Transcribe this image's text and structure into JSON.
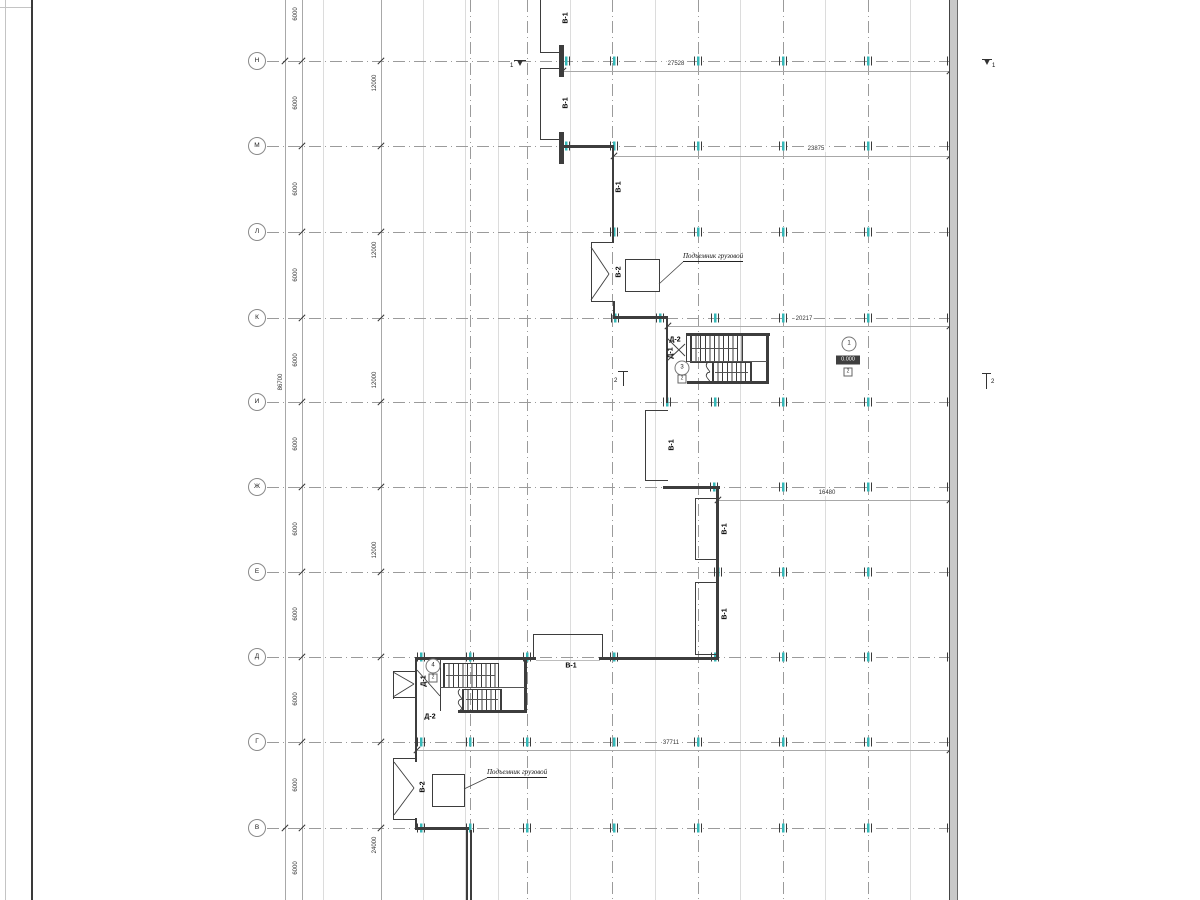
{
  "drawing_title": "floor-plan",
  "colors": {
    "wall": "#3d3d3d",
    "grid": "#9b9b9b",
    "tick_teal": "#35b8b8",
    "dim": "#a8a8a8",
    "elev_bg": "#3f3f3f"
  },
  "frame": {
    "lines_x": [
      5,
      31
    ],
    "top_line_y": 7
  },
  "grid": {
    "circle_x": 257,
    "line_x1": 267,
    "line_x2": 957,
    "rows": [
      {
        "label": "Н",
        "y": 61
      },
      {
        "label": "М",
        "y": 146
      },
      {
        "label": "Л",
        "y": 232
      },
      {
        "label": "К",
        "y": 318
      },
      {
        "label": "И",
        "y": 402
      },
      {
        "label": "Ж",
        "y": 487
      },
      {
        "label": "Е",
        "y": 572
      },
      {
        "label": "Д",
        "y": 657
      },
      {
        "label": "Г",
        "y": 742
      },
      {
        "label": "В",
        "y": 828
      }
    ],
    "columns_x": [
      470,
      527,
      612,
      698,
      783,
      868,
      952
    ],
    "minor_x": [
      323,
      423,
      465,
      498,
      570,
      655,
      740,
      825,
      910
    ]
  },
  "ticks": [
    {
      "y": 61,
      "xs": [
        566,
        614,
        698,
        783,
        868,
        951
      ]
    },
    {
      "y": 146,
      "xs": [
        566,
        614,
        698,
        783,
        868,
        951
      ]
    },
    {
      "y": 232,
      "xs": [
        614,
        698,
        783,
        868,
        951
      ]
    },
    {
      "y": 318,
      "xs": [
        615,
        660,
        715,
        783,
        868,
        951
      ]
    },
    {
      "y": 402,
      "xs": [
        667,
        715,
        783,
        868,
        951
      ]
    },
    {
      "y": 487,
      "xs": [
        714,
        783,
        868,
        951
      ]
    },
    {
      "y": 572,
      "xs": [
        718,
        783,
        868,
        951
      ]
    },
    {
      "y": 657,
      "xs": [
        421,
        470,
        527,
        614,
        715,
        783,
        868,
        951
      ]
    },
    {
      "y": 742,
      "xs": [
        421,
        470,
        527,
        614,
        698,
        783,
        868,
        951
      ]
    },
    {
      "y": 828,
      "xs": [
        421,
        470,
        527,
        614,
        698,
        783,
        868,
        951
      ]
    }
  ],
  "chains": {
    "total": {
      "x": 285,
      "label": "86700",
      "label_y": 382,
      "slash_ys": [
        61,
        828
      ]
    },
    "seg6000": {
      "x": 302,
      "label": "6000",
      "label_ys": [
        14,
        103,
        189,
        275,
        360,
        444,
        529,
        614,
        699,
        785,
        868
      ]
    },
    "seg12000": {
      "x": 381,
      "items": [
        {
          "t": "12000",
          "y": 83
        },
        {
          "t": "12000",
          "y": 250
        },
        {
          "t": "12000",
          "y": 380
        },
        {
          "t": "12000",
          "y": 550
        },
        {
          "t": "24000",
          "y": 845
        }
      ]
    }
  },
  "hdims": [
    {
      "t": "27528",
      "y": 71,
      "x1": 563,
      "x2": 950,
      "tx": 676
    },
    {
      "t": "23875",
      "y": 156,
      "x1": 614,
      "x2": 950,
      "tx": 816
    },
    {
      "t": "20217",
      "y": 326,
      "x1": 668,
      "x2": 950,
      "tx": 804
    },
    {
      "t": "16480",
      "y": 500,
      "x1": 718,
      "x2": 950,
      "tx": 827
    },
    {
      "t": "37711",
      "y": 750,
      "x1": 417,
      "x2": 950,
      "tx": 671
    }
  ],
  "walls": {
    "thin": [
      [
        540,
        0,
        1.3,
        53
      ],
      [
        540,
        52,
        23,
        1.3
      ],
      [
        540,
        68,
        1.3,
        72
      ],
      [
        540,
        68,
        23,
        1.3
      ],
      [
        540,
        139,
        23,
        1.3
      ],
      [
        591,
        242,
        23,
        1.3
      ],
      [
        591,
        242,
        1.3,
        60
      ],
      [
        591,
        301,
        24,
        1.3
      ],
      [
        613,
        301,
        1.5,
        17
      ],
      [
        645,
        410,
        1.3,
        71
      ],
      [
        645,
        410,
        23,
        1.3
      ],
      [
        645,
        480,
        23,
        1.3
      ],
      [
        695,
        498,
        1.3,
        62
      ],
      [
        695,
        498,
        22,
        1.3
      ],
      [
        695,
        559,
        22,
        1.3
      ],
      [
        695,
        582,
        1.3,
        73
      ],
      [
        695,
        582,
        22,
        1.3
      ],
      [
        695,
        654,
        22,
        1.3
      ],
      [
        533,
        634,
        1.3,
        24
      ],
      [
        533,
        634,
        70,
        1.3
      ],
      [
        602,
        634,
        1.3,
        24
      ],
      [
        393,
        671,
        22,
        1.3
      ],
      [
        393,
        671,
        1.3,
        28
      ],
      [
        393,
        697,
        22,
        1.3
      ],
      [
        393,
        758,
        22,
        1.3
      ],
      [
        393,
        758,
        1.3,
        62
      ],
      [
        393,
        819,
        22,
        1.3
      ],
      [
        440,
        660,
        1,
        51
      ],
      [
        686,
        333,
        1.3,
        29
      ]
    ],
    "med": [
      [
        612,
        145,
        2,
        98
      ],
      [
        666,
        318,
        2,
        85
      ],
      [
        716,
        487,
        3,
        172
      ],
      [
        415,
        658,
        2,
        104
      ],
      [
        415,
        818,
        2,
        12
      ],
      [
        466,
        830,
        1.5,
        70
      ],
      [
        470,
        830,
        1.5,
        70
      ],
      [
        559,
        45,
        4.5,
        32
      ],
      [
        559,
        132,
        4.5,
        32
      ],
      [
        562,
        145,
        52,
        2.5
      ],
      [
        613,
        316,
        55,
        2.5
      ],
      [
        663,
        486,
        57,
        2.5
      ],
      [
        415,
        657,
        121,
        2.5
      ],
      [
        599,
        657,
        120,
        2.5
      ],
      [
        687,
        333,
        83,
        2.5
      ],
      [
        766,
        333,
        2.5,
        50
      ],
      [
        687,
        381,
        82,
        2.5
      ],
      [
        524,
        660,
        2.5,
        52
      ],
      [
        458,
        710,
        69,
        2.5
      ],
      [
        415,
        827,
        54,
        2.5
      ]
    ],
    "thresholds": [
      [
        536,
        659.5,
        64,
        0.8
      ]
    ]
  },
  "right_wall": {
    "x": 949,
    "y": 0,
    "w": 7,
    "h": 900
  },
  "stairs": {
    "treads": [
      {
        "x": 690,
        "y": 335,
        "w": 51,
        "h": 26,
        "step": 4.6
      },
      {
        "x": 712,
        "y": 362,
        "w": 38,
        "h": 20,
        "step": 4.6
      },
      {
        "x": 443,
        "y": 663,
        "w": 54,
        "h": 23,
        "step": 4.6
      },
      {
        "x": 462,
        "y": 689,
        "w": 38,
        "h": 20,
        "step": 4.6
      }
    ],
    "dividers": [
      [
        687,
        361,
        80,
        1
      ],
      [
        440,
        687,
        85,
        1
      ]
    ],
    "arrows": [
      [
        692,
        348,
        737,
        348
      ],
      [
        715,
        372,
        748,
        372
      ],
      [
        446,
        675,
        495,
        675
      ],
      [
        466,
        699,
        498,
        699
      ]
    ]
  },
  "lifts": [
    {
      "x": 625,
      "y": 259,
      "w": 33,
      "h": 31
    },
    {
      "x": 432,
      "y": 774,
      "w": 31,
      "h": 31
    }
  ],
  "callouts": [
    {
      "t": "Подъемник грузовой",
      "x": 683,
      "y": 252,
      "leader": [
        683,
        262,
        659,
        284
      ]
    },
    {
      "t": "Подъемник грузовой",
      "x": 487,
      "y": 768,
      "leader": [
        487,
        778,
        464,
        789
      ]
    }
  ],
  "labels": [
    {
      "t": "В-1",
      "x": 566,
      "y": 18,
      "rot": true
    },
    {
      "t": "В-1",
      "x": 566,
      "y": 103,
      "rot": true
    },
    {
      "t": "В-1",
      "x": 619,
      "y": 187,
      "rot": true
    },
    {
      "t": "В-2",
      "x": 619,
      "y": 272,
      "rot": true
    },
    {
      "t": "Д-2",
      "x": 675,
      "y": 340,
      "rot": false
    },
    {
      "t": "Д-1",
      "x": 671,
      "y": 353,
      "rot": true
    },
    {
      "t": "В-1",
      "x": 672,
      "y": 445,
      "rot": true
    },
    {
      "t": "В-1",
      "x": 725,
      "y": 529,
      "rot": true
    },
    {
      "t": "В-1",
      "x": 725,
      "y": 614,
      "rot": true
    },
    {
      "t": "В-1",
      "x": 571,
      "y": 666,
      "rot": false
    },
    {
      "t": "Д-1",
      "x": 424,
      "y": 681,
      "rot": true
    },
    {
      "t": "Д-2",
      "x": 430,
      "y": 717,
      "rot": false
    },
    {
      "t": "В-2",
      "x": 423,
      "y": 787,
      "rot": true
    }
  ],
  "room_circles": [
    {
      "t": "3",
      "cx": 682,
      "cy": 368
    },
    {
      "t": "4",
      "cx": 433,
      "cy": 666
    },
    {
      "t": "1",
      "cx": 849,
      "cy": 344
    }
  ],
  "mini_boxes": [
    {
      "t": "2",
      "cx": 682,
      "cy": 379
    },
    {
      "t": "2",
      "cx": 433,
      "cy": 678
    },
    {
      "t": "2",
      "cx": 848,
      "cy": 372
    }
  ],
  "elevation": {
    "t": "0.000",
    "cx": 848,
    "cy": 360,
    "w": 24,
    "h": 9
  },
  "sections": [
    {
      "t": "1",
      "bar": [
        514,
        60,
        12
      ],
      "tip": [
        520,
        61
      ],
      "tx": 510,
      "ty": 66
    },
    {
      "t": "1",
      "bar": [
        982,
        59,
        10
      ],
      "tip": [
        987,
        60
      ],
      "tx": 992,
      "ty": 66
    },
    {
      "t": "2",
      "bar": [
        618,
        371,
        10
      ],
      "v": [
        623,
        371,
        15
      ],
      "tx": 614,
      "ty": 381
    },
    {
      "t": "2",
      "bar": [
        982,
        373,
        9
      ],
      "v": [
        986,
        373,
        16
      ],
      "tx": 991,
      "ty": 382
    }
  ],
  "diagonals": [
    [
      591,
      247,
      609,
      274
    ],
    [
      591,
      300,
      609,
      274
    ],
    [
      667,
      338,
      685,
      356
    ],
    [
      667,
      361,
      685,
      344
    ],
    [
      417,
      670,
      440,
      696
    ],
    [
      393,
      672,
      414,
      684
    ],
    [
      393,
      697,
      414,
      684
    ],
    [
      394,
      762,
      414,
      788
    ],
    [
      394,
      815,
      414,
      788
    ]
  ],
  "squiggles": [
    {
      "x": 708,
      "y1": 362,
      "y2": 383
    },
    {
      "x": 460,
      "y1": 689,
      "y2": 710
    }
  ]
}
